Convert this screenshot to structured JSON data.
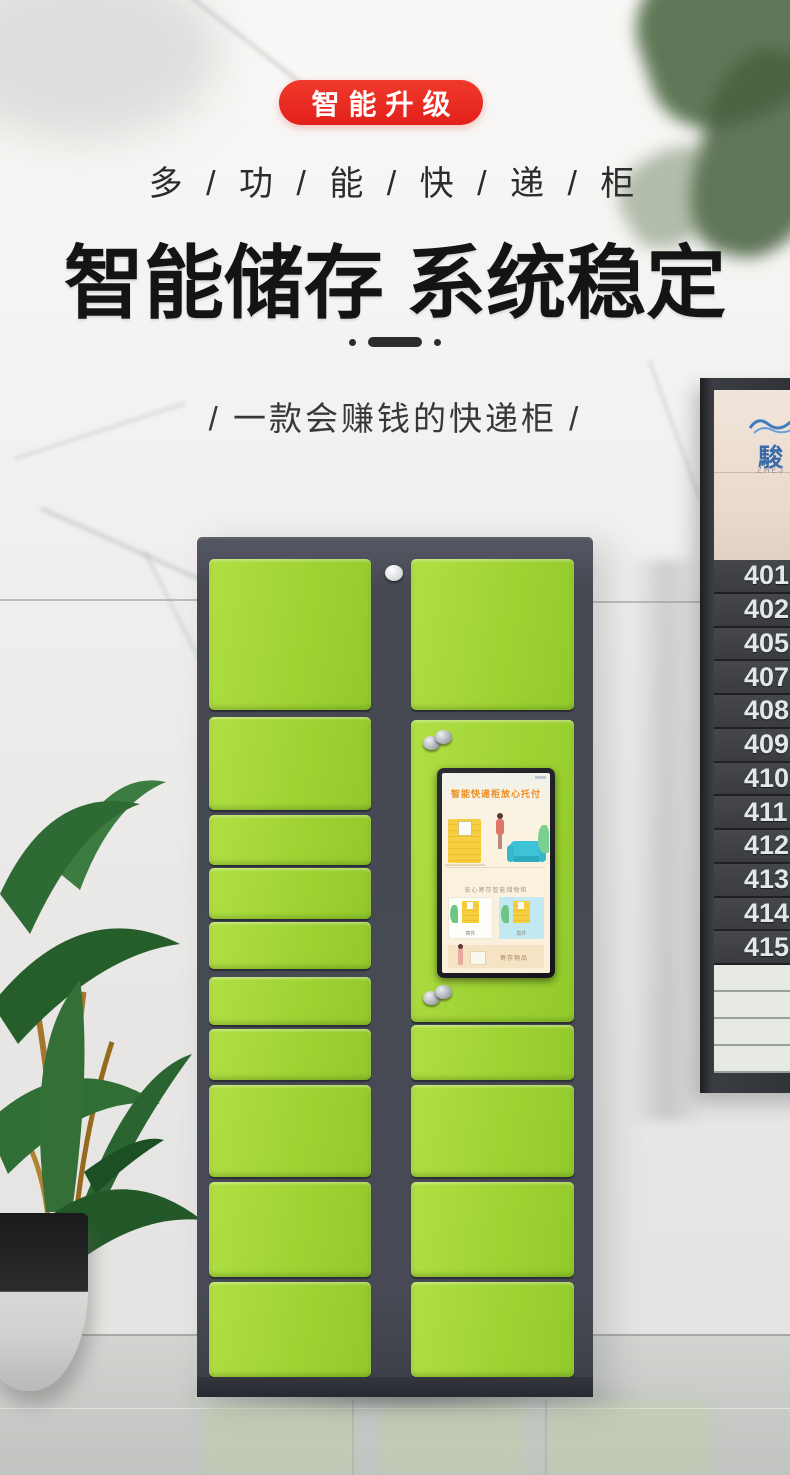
{
  "colors": {
    "badge_red": "#e2201b",
    "door_green": "#9fd334",
    "frame_gray": "#474a54",
    "screen_accent_orange": "#ee8a1e",
    "sign_brand_blue": "#3a6ba6"
  },
  "header": {
    "badge": "智能升级",
    "tagline": "多 / 功 / 能 / 快 / 递 / 柜",
    "title": "智能储存 系统稳定",
    "subtitle": "/ 一款会赚钱的快递柜 /"
  },
  "kiosk_screen": {
    "title": "智能快递柜放心托付",
    "caption": "安心寄存智能储物柜",
    "card_left_label": "寄件",
    "card_right_label": "取件",
    "bottom_card_label": "寄存物品"
  },
  "sign": {
    "brand_cn": "駿",
    "brand_en": "ZHEJ",
    "room_numbers": [
      "401",
      "402",
      "405",
      "407",
      "408",
      "409",
      "410",
      "411",
      "412",
      "413",
      "414",
      "415"
    ]
  }
}
